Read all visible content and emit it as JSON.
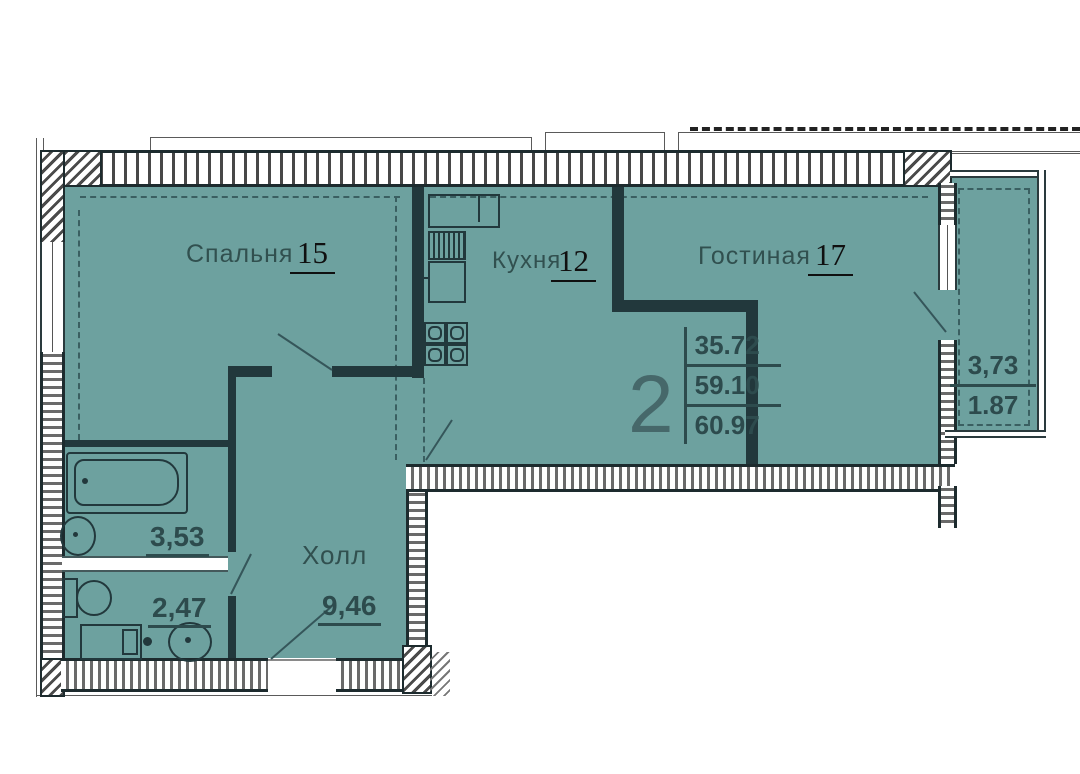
{
  "title": "2-room apartment floor plan",
  "summary": {
    "rooms_count": "2",
    "living_area": "35.72",
    "floor_area": "59.10",
    "total_area": "60.97"
  },
  "rooms": {
    "bedroom": {
      "name": "Спальня",
      "area": "15"
    },
    "kitchen": {
      "name": "Кухня",
      "area": "12"
    },
    "living_room": {
      "name": "Гостиная",
      "area": "17"
    },
    "hall": {
      "name": "Холл",
      "area": "9,46"
    },
    "bathroom": {
      "area": "3,53"
    },
    "toilet": {
      "area": "2,47"
    },
    "balcony": {
      "area": "3,73",
      "area_coefficient": "1.87"
    }
  },
  "colors": {
    "room_fill": "#6da19f",
    "wall_dark": "#22383c",
    "label_text": "#31504f",
    "value_text": "#2d4b4d",
    "number_black": "#101010"
  }
}
